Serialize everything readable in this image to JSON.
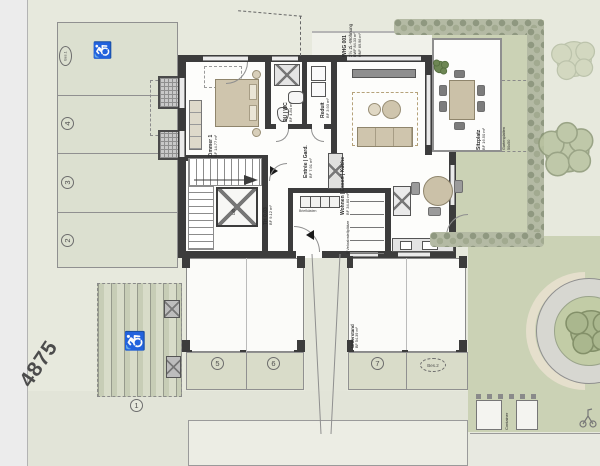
{
  "plan": {
    "street_number": "4875",
    "unit": {
      "id": "WHG 001",
      "type": "2½ Zi.-Wohnung",
      "area_bwf": "BWF 84.33 m²",
      "area_hnf": "HNF 69.96 m²"
    },
    "rooms": {
      "zimmer1": {
        "name": "Zimmer 1",
        "area": "BF 14.77 m²"
      },
      "duwc": {
        "name": "DU | WC",
        "area": "BF 4.84 m²"
      },
      "reduit": {
        "name": "Reduit",
        "area": "BF 3.93 m²"
      },
      "entree": {
        "name": "Entrée | Gard.",
        "area": "BF 7.91 m²"
      },
      "wohnen": {
        "name": "Wohnen | Essen | Küche",
        "area": "BF 34.80 m²"
      },
      "treppenhaus": {
        "name": "TH 0.03",
        "area": "BF 9.12 m²"
      },
      "lift": {
        "name": "Lift"
      },
      "velo": {
        "name": "5 Veloabstellplätze"
      },
      "briefkaesten": {
        "name": "Briefkästen"
      }
    },
    "outdoor": {
      "sitzplatz": {
        "name": "Sitzplatz",
        "area": "BF 16.50 m²"
      },
      "unterstand": {
        "name": "Unterstand",
        "area": "BF 54.39 m²"
      },
      "garden_path": {
        "line1": "Gartenplatten",
        "line2": "50x50"
      },
      "container_label": "Container"
    },
    "parking": {
      "left_column": [
        "Bes.1",
        "4",
        "3",
        "2"
      ],
      "bottom_row": [
        "5",
        "6",
        "7",
        "Bes.2"
      ],
      "grass_stall": "1"
    },
    "icons": {
      "wheelchair": "♿"
    },
    "colors": {
      "background": "#e7e9dd",
      "lawn": "#cbd2b5",
      "wall": "#3c3c3c",
      "stall_fill": "#dce0d0",
      "road": "#ececec",
      "furniture": "#cfc5ad",
      "hedge": "#9aa38e"
    }
  }
}
